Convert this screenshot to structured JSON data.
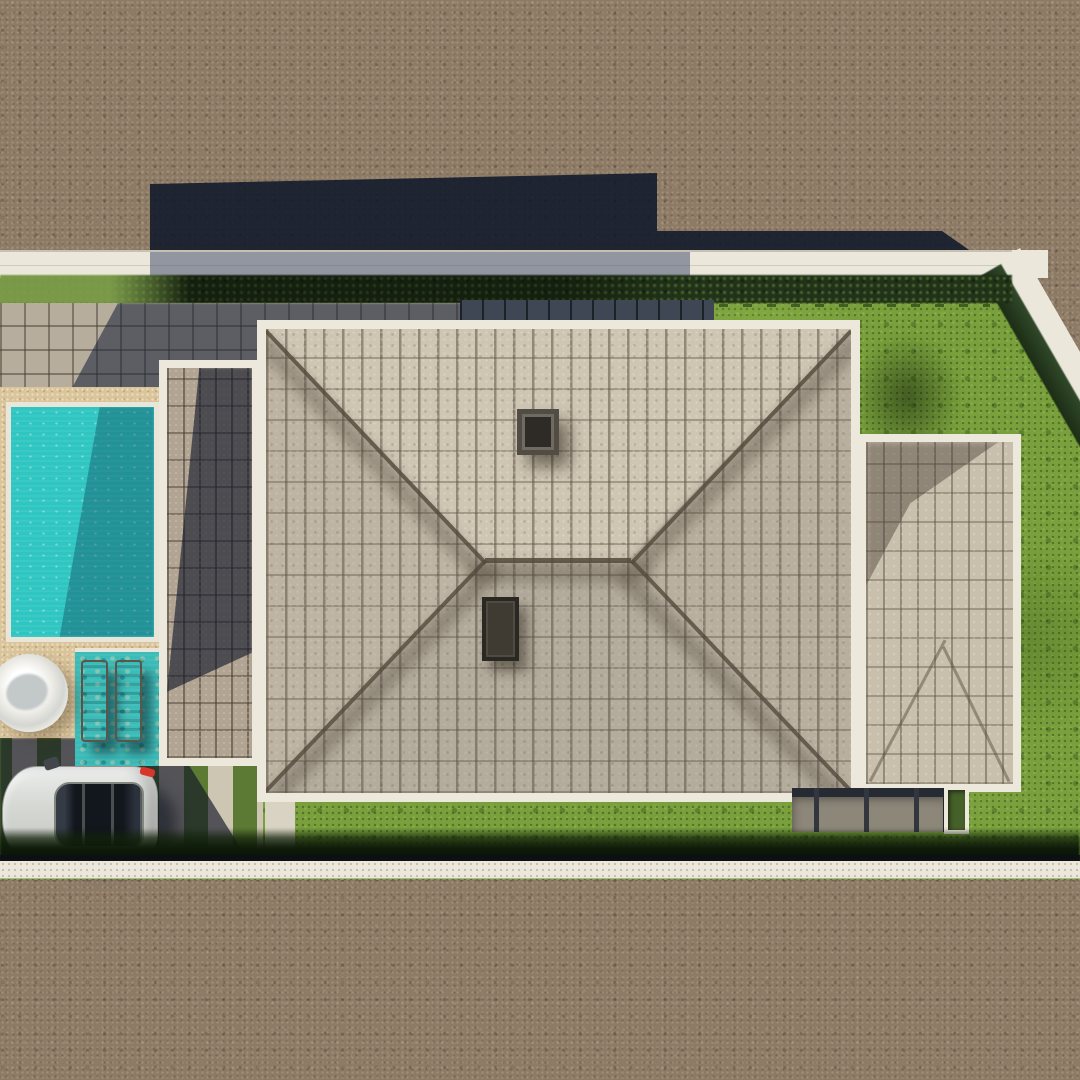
{
  "meta": {
    "title": "Aerial 3D render of a residential plot",
    "description": "Top-down architectural visualization: hip-roof villa with annex roof, carport strip roof, turquoise swimming pool with sun shelf and loungers, round spa, sand pool deck, ribbon driveway with parked silver car, square-tile patio, dark paver entry path, lawns, hedge boundaries, white sidewalks and surrounding brown gravel streets with long building shadows."
  },
  "colors": {
    "street": "#8d7b66",
    "building-shadow": "#10182b",
    "sidewalk": "#ece7db",
    "front-hedge": "#22351a",
    "lawn": "#79a03c",
    "tile-patio": "#b6ad9c",
    "entry-path": "#3f4654",
    "pool-deck": "#d9c49c",
    "pool": "#2fc6c2",
    "sun-shelf": "#3cbcb8",
    "driveway-concrete": "#cdc6b2",
    "driveway-grass": "#5c7a33",
    "walkway": "#d8d3c2",
    "taillight": "#d7352c",
    "fascia": "#ece8dc",
    "carport": "#b1a492",
    "main-roof": "#cec5b3",
    "chimney": "#514d44",
    "roof-vent": "#3f3b33",
    "annex": "#c9bfad",
    "terrace": "#8d8779",
    "planter": "#46602a",
    "fence": "#0d1014"
  },
  "objects": {
    "street": {
      "label": "Gravel street"
    },
    "building_shadow": {
      "label": "Building shadow cast on street"
    },
    "lawn": {
      "label": "Lawn"
    },
    "tree_shadow": {
      "label": "Shadow patch on lawn"
    },
    "lawn_seam": {
      "label": "Dashed lawn seam"
    },
    "front_sidewalk": {
      "label": "Front sidewalk and curb"
    },
    "side_sidewalk": {
      "label": "Side sidewalk along angled boundary"
    },
    "front_hedge": {
      "label": "Front hedge row"
    },
    "side_hedge": {
      "label": "Side boundary hedge"
    },
    "tile_patio": {
      "label": "Square-tile patio"
    },
    "entry_path": {
      "label": "Dark paver entry path"
    },
    "pool_deck": {
      "label": "Sand pool deck"
    },
    "pool": {
      "label": "Swimming pool"
    },
    "sun_shelf": {
      "label": "Pool sun shelf"
    },
    "lounger": {
      "label": "Sun lounger"
    },
    "spa": {
      "label": "Round spa"
    },
    "driveway": {
      "label": "Ribbon driveway"
    },
    "walkway": {
      "label": "Entry walkway"
    },
    "car": {
      "label": "Parked silver car"
    },
    "carport_roof": {
      "label": "Carport strip roof"
    },
    "main_roof": {
      "label": "Main hip roof"
    },
    "chimney": {
      "label": "Chimney"
    },
    "roof_vent": {
      "label": "Roof vent"
    },
    "annex_roof": {
      "label": "Annex roof"
    },
    "terrace": {
      "label": "Covered rear terrace"
    },
    "planter_box": {
      "label": "Planter box"
    },
    "rear_hedge": {
      "label": "Rear hedge band"
    },
    "boundary_fence": {
      "label": "Boundary fence line"
    },
    "rear_sidewalk": {
      "label": "Rear sidewalk"
    }
  }
}
